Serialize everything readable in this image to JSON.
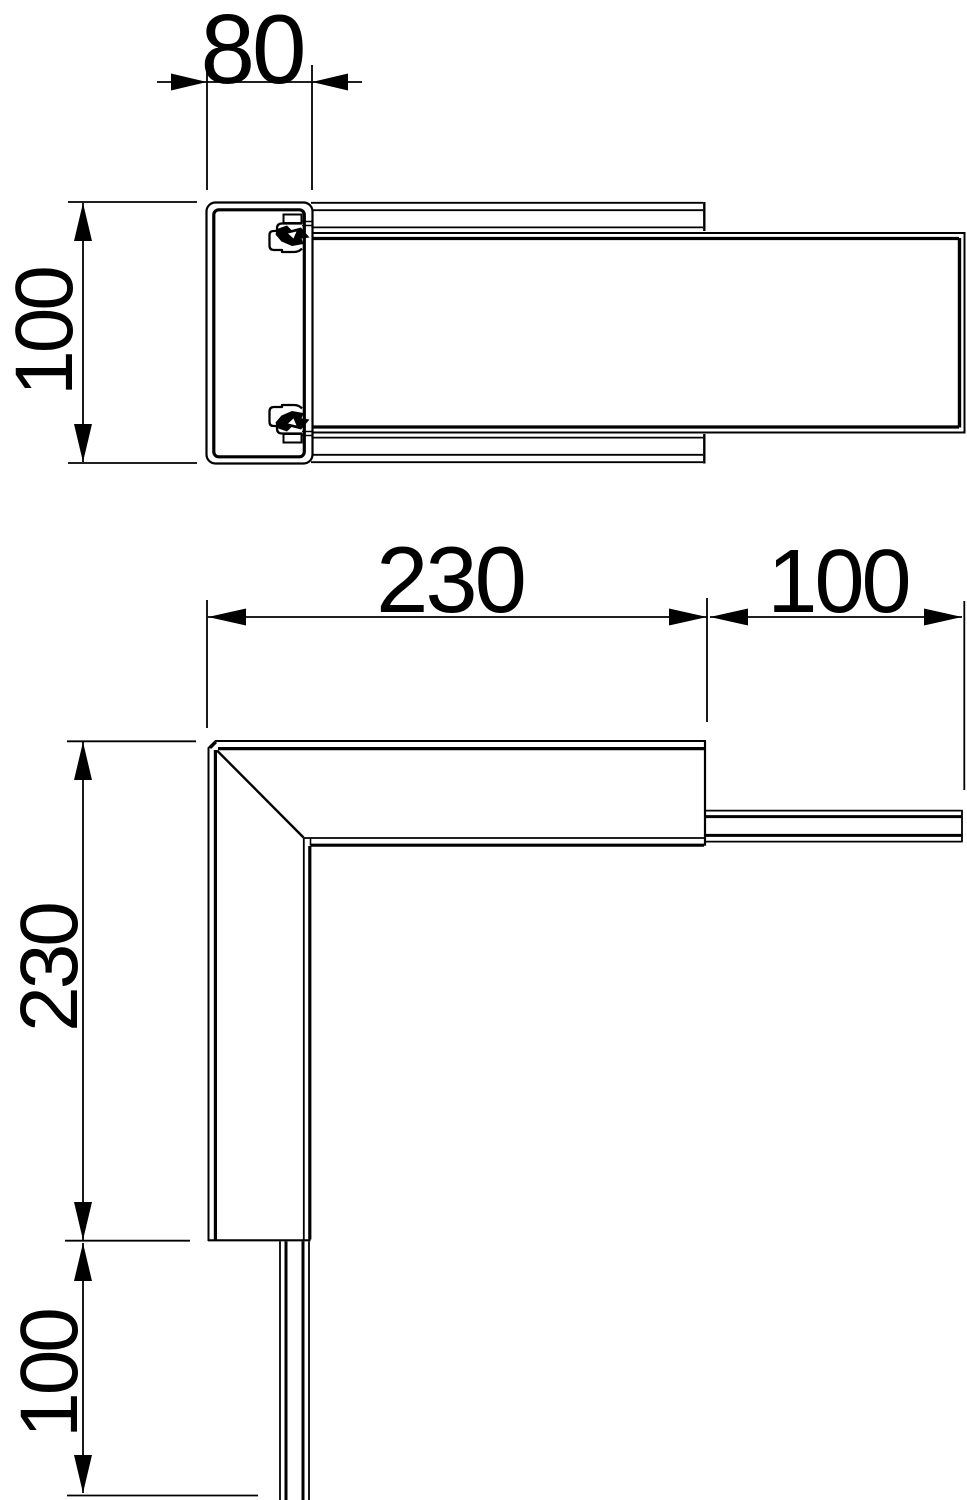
{
  "canvas": {
    "background": "#ffffff",
    "line_color": "#000000"
  },
  "drawing": {
    "kind": "technical-dimension-drawing",
    "views": {
      "side": {
        "name": "profile-section-view",
        "width_label": "80",
        "height_label": "100"
      },
      "plan": {
        "name": "corner-plan-view",
        "length_label": "230",
        "width_label": "100",
        "length_label_vertical": "230",
        "width_label_vertical": "100"
      }
    }
  }
}
